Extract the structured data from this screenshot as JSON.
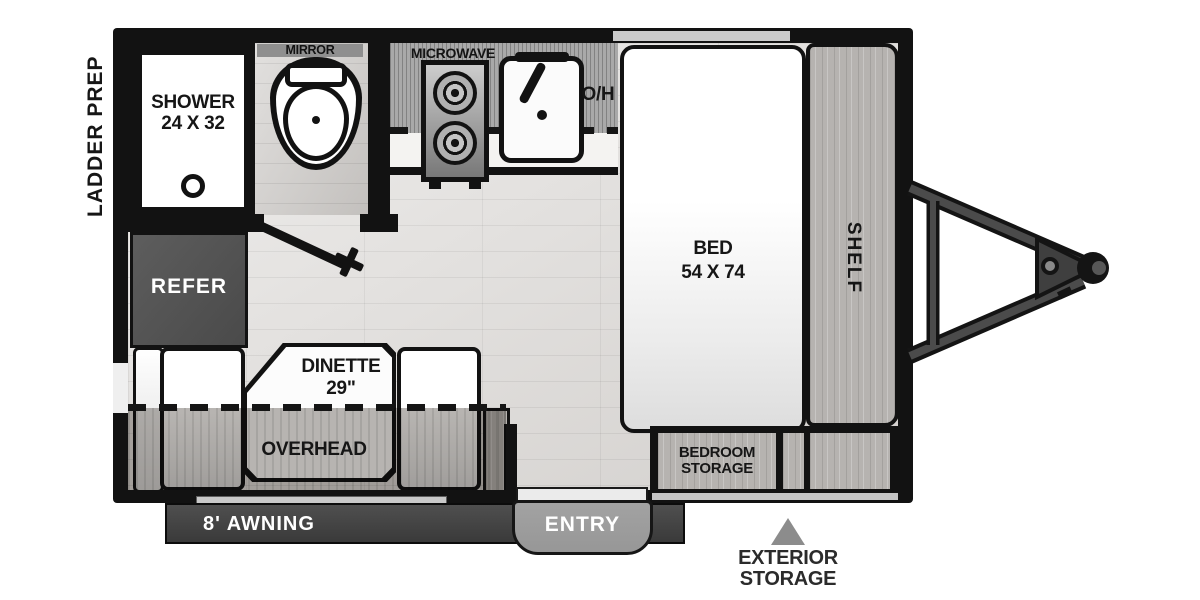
{
  "labels": {
    "ladder_prep": "LADDER PREP",
    "shower_line1": "SHOWER",
    "shower_line2": "24 X 32",
    "mirror": "MIRROR",
    "microwave": "MICROWAVE",
    "overhead_abbrev": "O/H",
    "bed_line1": "BED",
    "bed_line2": "54 X 74",
    "shelf": "SHELF",
    "refer": "REFER",
    "dinette_line1": "DINETTE",
    "dinette_line2": "29\"",
    "overhead": "OVERHEAD",
    "awning": "8' AWNING",
    "entry": "ENTRY",
    "bedroom_storage_line1": "BEDROOM",
    "bedroom_storage_line2": "STORAGE",
    "exterior_storage_line1": "EXTERIOR",
    "exterior_storage_line2": "STORAGE"
  },
  "colors": {
    "wall": "#121212",
    "refer": "#4a4a4a",
    "awning": "#3a3a3a",
    "step": "#979797",
    "triangle": "#8c8c8c"
  }
}
